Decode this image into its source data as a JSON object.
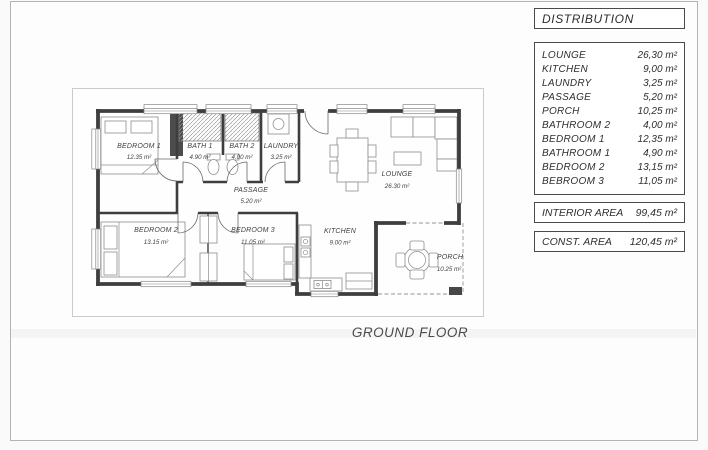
{
  "page": {
    "caption": "GROUND FLOOR"
  },
  "distribution": {
    "header": "DISTRIBUTION",
    "rows": [
      {
        "label": "LOUNGE",
        "value": "26,30 m²"
      },
      {
        "label": "KITCHEN",
        "value": "9,00 m²"
      },
      {
        "label": "LAUNDRY",
        "value": "3,25 m²"
      },
      {
        "label": "PASSAGE",
        "value": "5,20 m²"
      },
      {
        "label": "PORCH",
        "value": "10,25 m²"
      },
      {
        "label": "BATHROOM 2",
        "value": "4,00 m²"
      },
      {
        "label": "BEDROOM 1",
        "value": "12,35 m²"
      },
      {
        "label": "BATHROOM 1",
        "value": "4,90 m²"
      },
      {
        "label": "BEDROOM 2",
        "value": "13,15 m²"
      },
      {
        "label": "BEBROOM 3",
        "value": "11,05 m²"
      }
    ],
    "interior_area": {
      "label": "INTERIOR AREA",
      "value": "99,45 m²"
    },
    "const_area": {
      "label": "CONST. AREA",
      "value": "120,45 m²"
    }
  },
  "plan": {
    "rooms": [
      {
        "name": "BEDROOM 1",
        "area": "12.35 m²"
      },
      {
        "name": "BATH 1",
        "area": "4.90 m²"
      },
      {
        "name": "BATH 2",
        "area": "4.00 m²"
      },
      {
        "name": "LAUNDRY",
        "area": "3.25 m²"
      },
      {
        "name": "PASSAGE",
        "area": "5.20 m²"
      },
      {
        "name": "LOUNGE",
        "area": "26.30 m²"
      },
      {
        "name": "BEDROOM 2",
        "area": "13.15 m²"
      },
      {
        "name": "BEDROOM 3",
        "area": "11.05 m²"
      },
      {
        "name": "KITCHEN",
        "area": "9.00 m²"
      },
      {
        "name": "PORCH",
        "area": "10.25 m²"
      }
    ]
  },
  "colors": {
    "wall": "#3e3e3e",
    "furniture": "#8d8d8d",
    "text": "#3f3f3f",
    "box_border": "#4a4a4a"
  }
}
